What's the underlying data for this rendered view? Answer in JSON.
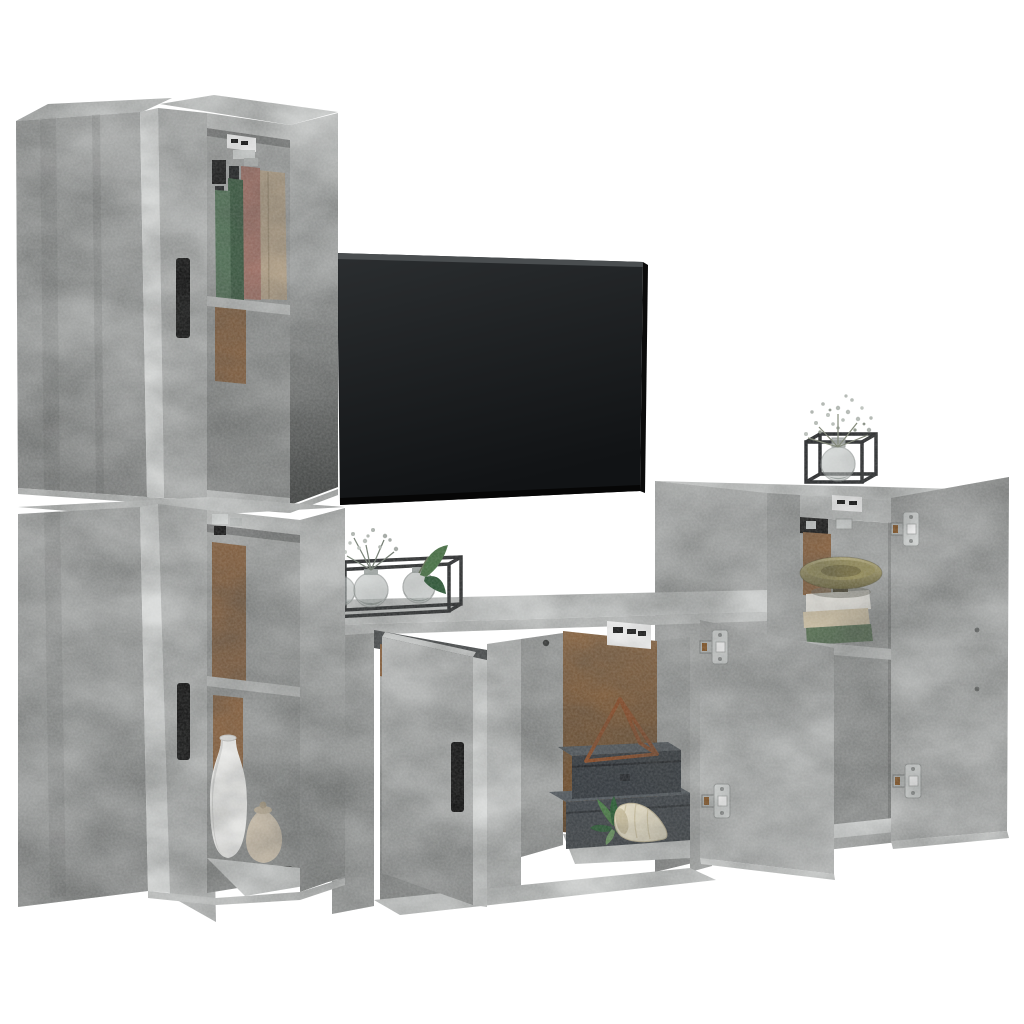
{
  "scene": {
    "type": "product_photo",
    "description": "4-piece concrete grey wall-mounted TV cabinet set with open doors, styled with books, vases, plants, storage boxes, a decorative bowl and a black flat-screen TV, on a plain white studio background",
    "background": "#ffffff",
    "objects": [
      "upper-left tall wall cabinet with open door, black handle, books on shelf",
      "lower-left tall wall cabinet with open door, black handle, white and beige vases",
      "black flat-screen TV mounted on wall",
      "TV bench with two open doors, metal stand with three glass ball vases and plants",
      "center compartment with dark storage boxes, rust metal pyramid, succulent and shell",
      "right wall cabinet with open door, gold bowl on stacked books",
      "black cube frame vase with white gypsophila on right cabinet top"
    ]
  },
  "palette": {
    "concrete_top": "#cdcfce",
    "concrete_light": "#c3c5c4",
    "concrete_mid": "#acaead",
    "concrete_mid2": "#a2a4a3",
    "concrete_side": "#a8aaa9",
    "concrete_door": "#b5b7b6",
    "concrete_door2": "#bcbebd",
    "edge_highlight": "#d9dbda",
    "hardboard": "#8a6544",
    "tv_screen": "#1a1c1e",
    "handle_black": "#141414",
    "metal_frame": "#2a2c2e",
    "hinge_silver": "#d6d9d8",
    "hinge_bronze": "#8a5a2a",
    "book_green": "#55735a",
    "book_green_dark": "#3f5d45",
    "book_rose": "#a3756a",
    "book_beige": "#b3a28a",
    "stack_white": "#e9e7e1",
    "stack_cream": "#d3c6ab",
    "stack_green": "#5c7458",
    "box_front": "#43484d",
    "box_front_dark": "#393e43",
    "box_top": "#565c61",
    "pyramid_rust": "#8a4f2c",
    "plant_green": "#4e7d4a",
    "plant_green_dark": "#2e5f38",
    "shell_cream": "#ece4cc",
    "vase_white": "#f3f3f1",
    "vase_beige": "#cfc3b0",
    "bowl_gold": "#b0a671",
    "glass_grey": "#c6cccb",
    "flower_white": "#c9cfc9",
    "label_white": "#ffffff",
    "bracket_black": "#1d1d1d"
  }
}
